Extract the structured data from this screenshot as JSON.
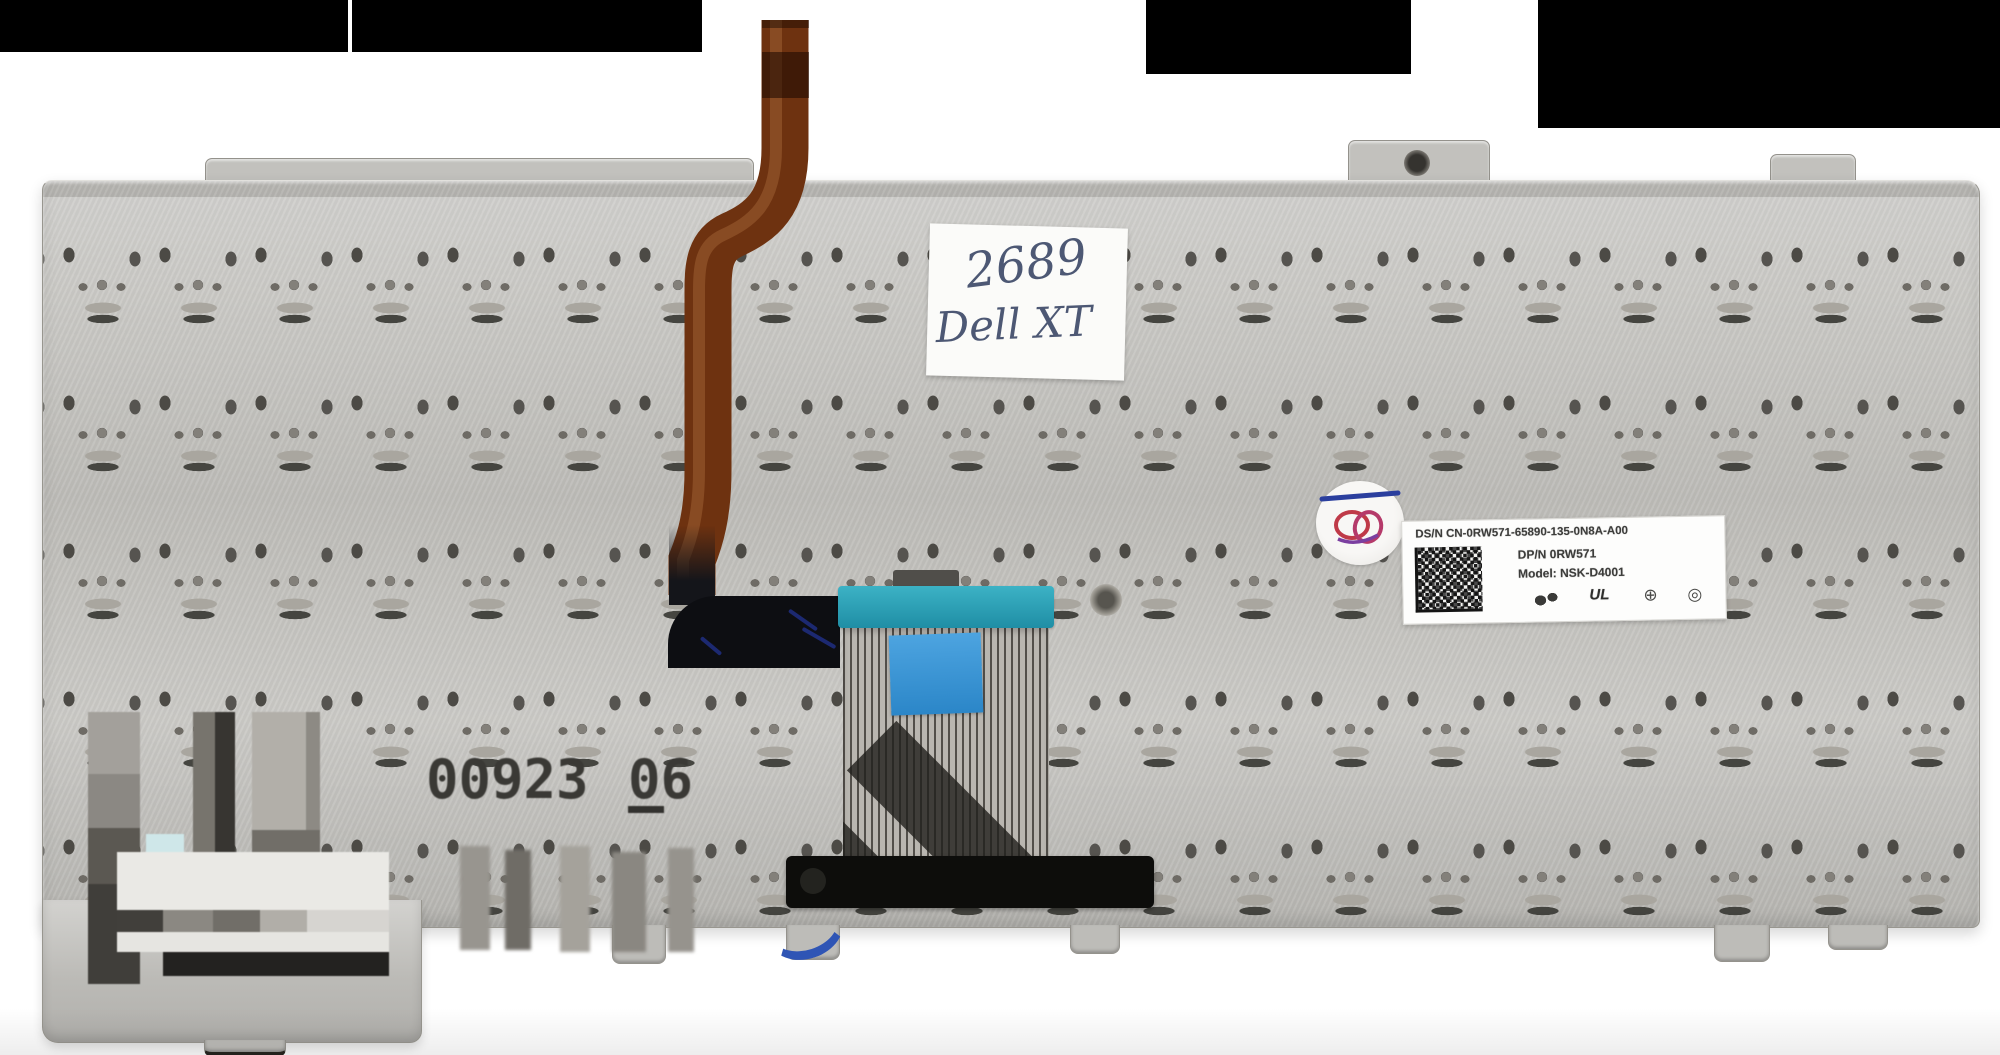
{
  "photo": {
    "subject": "laptop keyboard back plate product photo",
    "colors": {
      "background": "#ffffff",
      "plate": "#c6c5c1",
      "censor_bar": "#000000",
      "ribbon_cable_copper": "#6e3210",
      "teal_tape": "#2ba4b8",
      "blue_tape": "#2f8fd2",
      "note_ink": "#4d5874",
      "qc_scribble_red": "#bf3a48",
      "qc_pen_blue": "#2b3f9e"
    },
    "note": {
      "line1": "2689",
      "line2": "Dell XT"
    },
    "stamp": {
      "left": "00923",
      "right": "06"
    },
    "label": {
      "line1": "DS/N CN-0RW571-65890-135-0N8A-A00",
      "line2": "DP/N 0RW571",
      "line3": "Model: NSK-D4001",
      "ul_mark": "UL",
      "mark_circle1": "⊕",
      "mark_circle2": "◎"
    }
  }
}
